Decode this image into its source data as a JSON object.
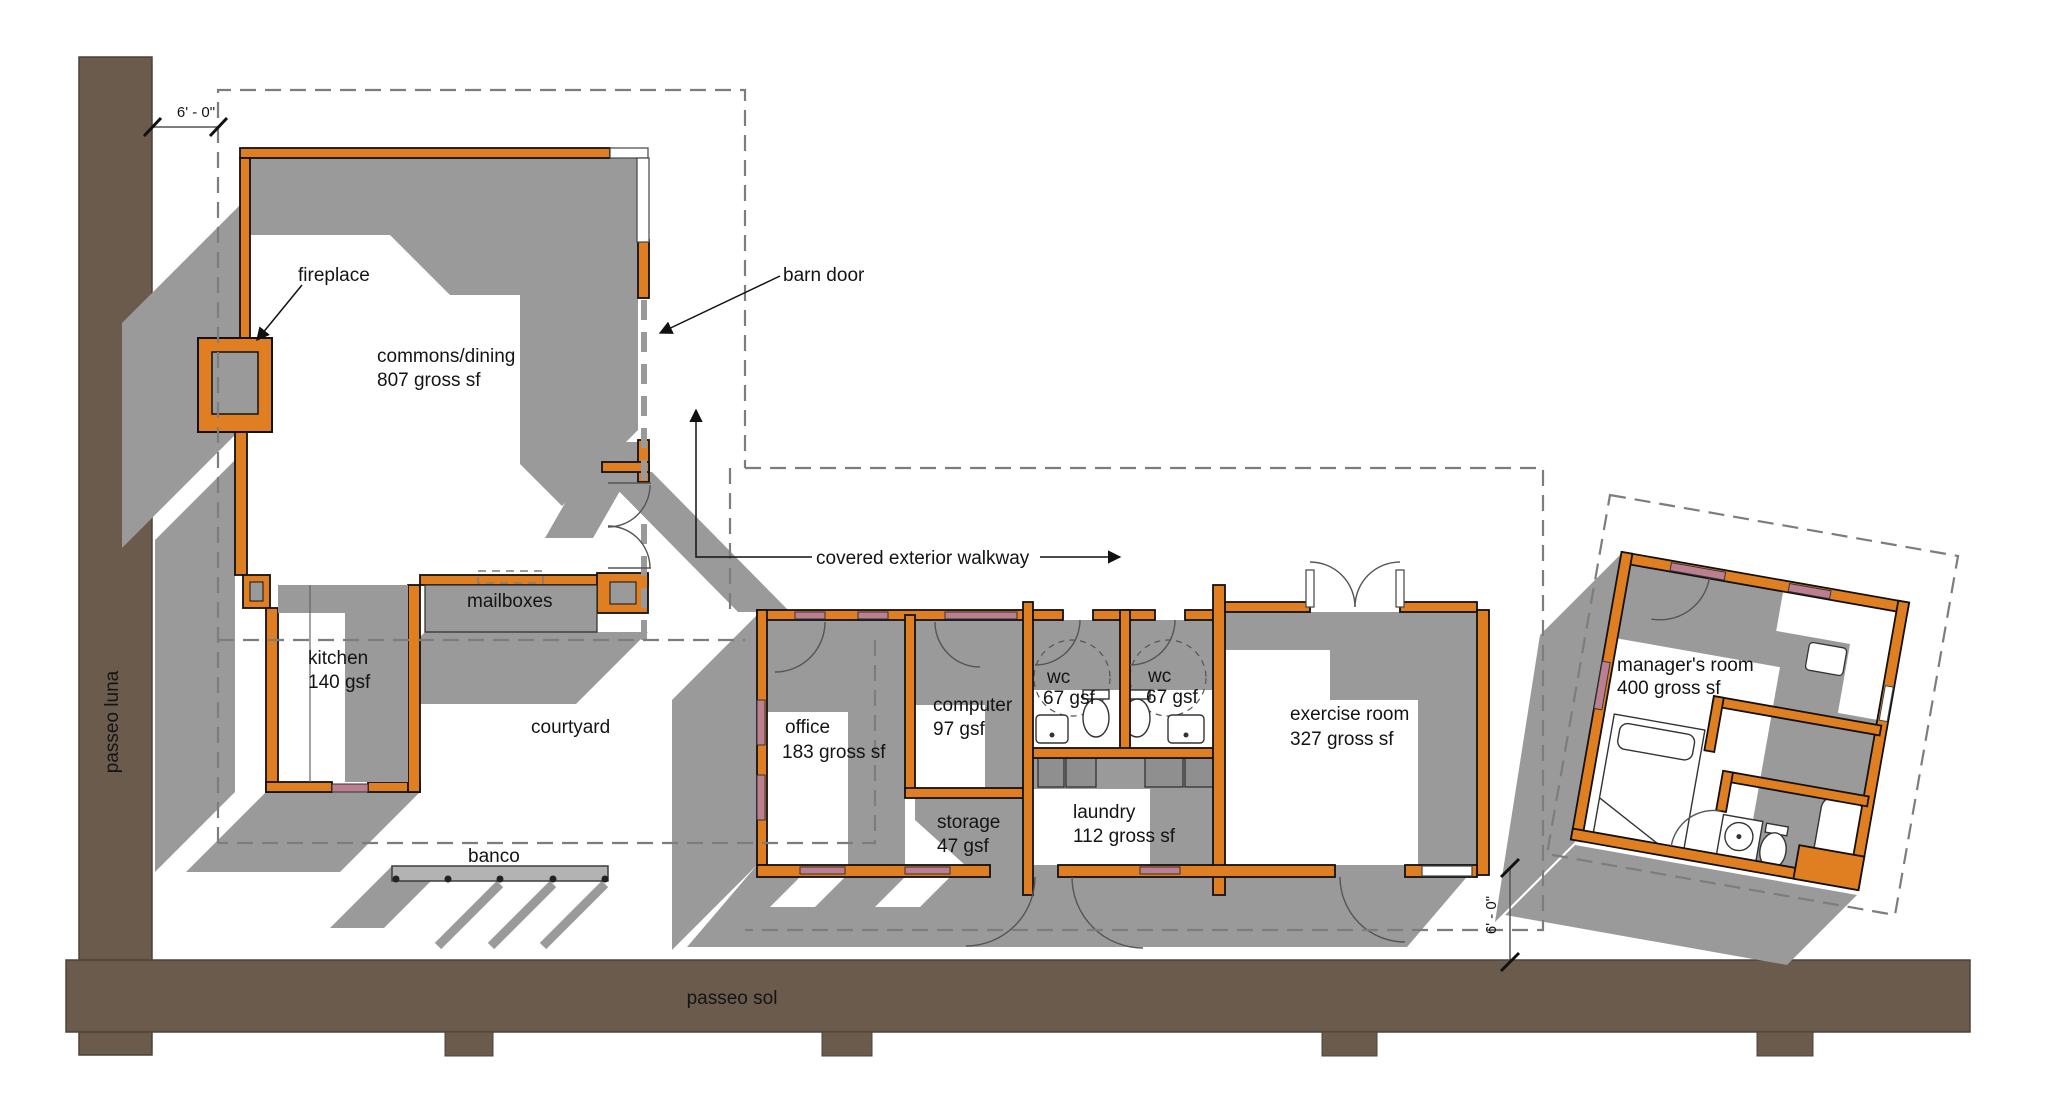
{
  "drawing": {
    "type": "architectural floor plan",
    "colors": {
      "road": "#6a5b4d",
      "wall_orange": "#e07e22",
      "shadow_gray": "#9a9a9a",
      "window_pink": "#bb7f90",
      "dash_gray": "#7d7d7d",
      "text": "#141414"
    }
  },
  "streets": {
    "left": "passeo luna",
    "bottom": "passeo sol"
  },
  "dimensions": {
    "top_left": "6' - 0\"",
    "right": "6' - 0\""
  },
  "annotations": {
    "fireplace": "fireplace",
    "barn_door": "barn door",
    "walkway": "covered exterior walkway",
    "mailboxes": "mailboxes",
    "courtyard": "courtyard",
    "banco": "banco"
  },
  "rooms": {
    "commons": {
      "name": "commons/dining",
      "area": "807 gross sf"
    },
    "kitchen": {
      "name": "kitchen",
      "area": "140 gsf"
    },
    "office": {
      "name": "office",
      "area": "183 gross sf"
    },
    "computer": {
      "name": "computer",
      "area": "97 gsf"
    },
    "storage": {
      "name": "storage",
      "area": "47 gsf"
    },
    "wc1": {
      "name": "wc",
      "area": "67 gsf"
    },
    "wc2": {
      "name": "wc",
      "area": "67 gsf"
    },
    "laundry": {
      "name": "laundry",
      "area": "112 gross sf"
    },
    "exercise": {
      "name": "exercise room",
      "area": "327 gross sf"
    },
    "managers": {
      "name": "manager's room",
      "area": "400 gross sf"
    }
  }
}
